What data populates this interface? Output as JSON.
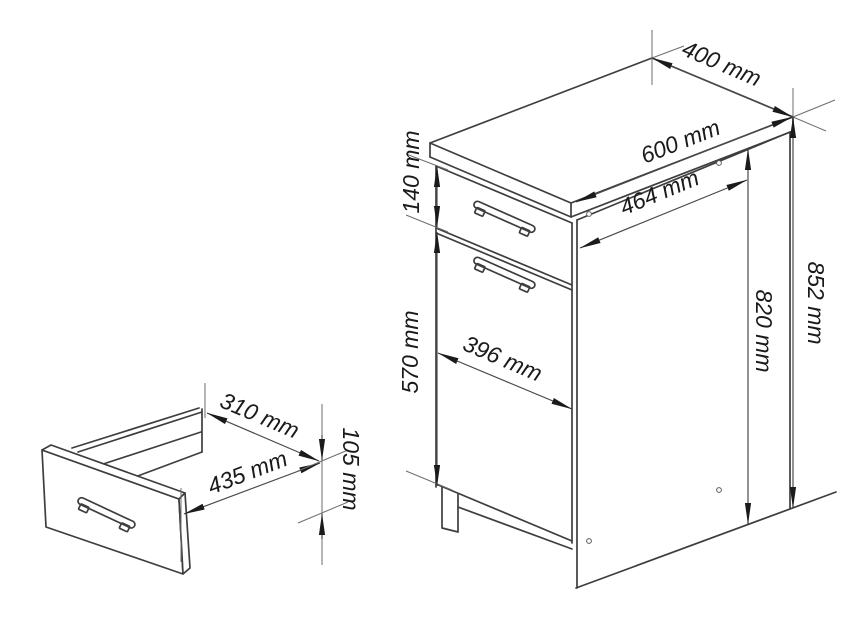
{
  "diagram": {
    "title": "Kitchen base cabinet with drawer - dimension diagram",
    "unit": "mm",
    "colors": {
      "background": "#ffffff",
      "outline": "#3e3e3e",
      "dimension_line": "#4a4a4a",
      "extension_line": "#6e6e6e",
      "arrow": "#1b1b1b",
      "text": "#1a1a1a"
    },
    "cabinet": {
      "labels": {
        "top_width": "400 mm",
        "top_depth": "600 mm",
        "body_depth": "464 mm",
        "total_height": "852 mm",
        "carcass_height": "820 mm",
        "drawer_front_height": "140 mm",
        "door_height": "570 mm",
        "door_width": "396 mm"
      }
    },
    "drawer": {
      "labels": {
        "inner_depth": "310 mm",
        "inner_width": "435 mm",
        "inner_height": "105 mm"
      }
    }
  }
}
